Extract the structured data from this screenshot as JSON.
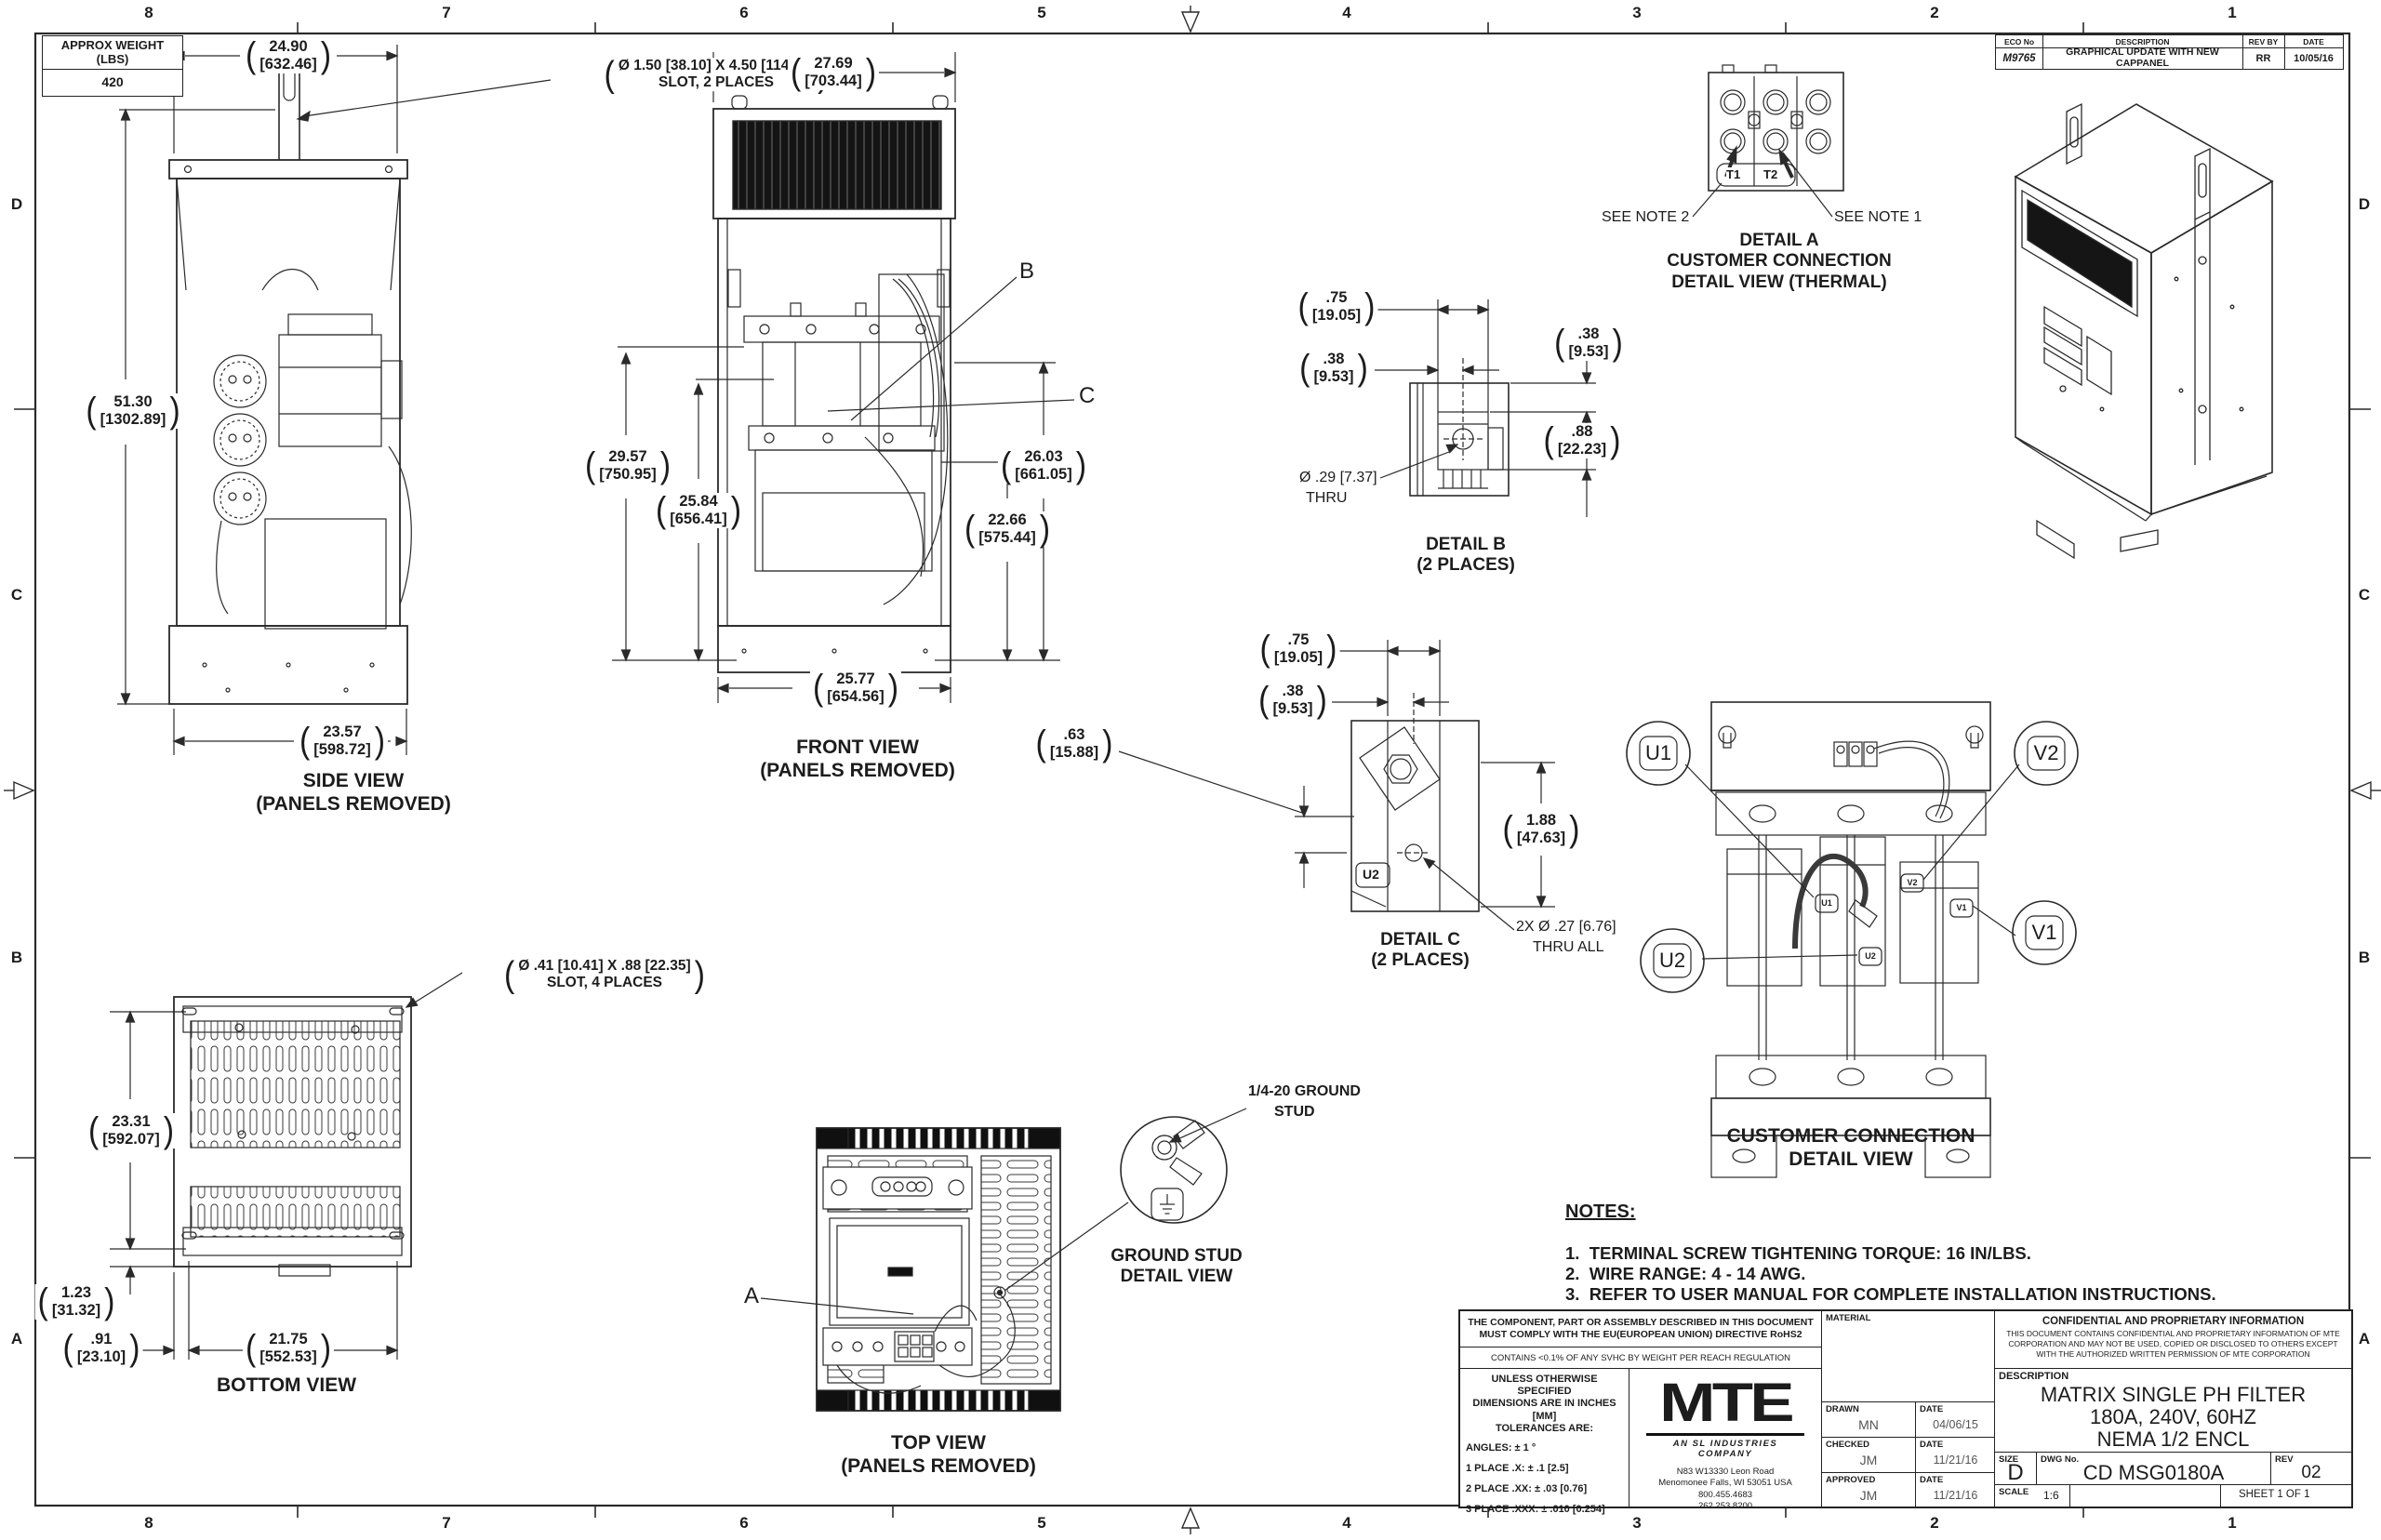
{
  "sheet": {
    "zones_top": [
      "8",
      "7",
      "6",
      "5",
      "4",
      "3",
      "2",
      "1"
    ],
    "zones_bottom": [
      "8",
      "7",
      "6",
      "5",
      "4",
      "3",
      "2",
      "1"
    ],
    "zones_left": [
      "D",
      "C",
      "B",
      "A"
    ],
    "zones_right": [
      "D",
      "C",
      "B",
      "A"
    ]
  },
  "weight_table": {
    "title": "APPROX WEIGHT (LBS)",
    "value": "420"
  },
  "eco": {
    "h_eco": "ECO No",
    "h_desc": "DESCRIPTION",
    "h_rev": "REV BY",
    "h_date": "DATE",
    "eco_no": "M9765",
    "description": "GRAPHICAL UPDATE WITH NEW CAPPANEL",
    "rev_by": "RR",
    "date": "10/05/16"
  },
  "side": {
    "title": "SIDE VIEW",
    "subtitle": "(PANELS REMOVED)",
    "dim_top_in": "24.90",
    "dim_top_mm": "[632.46]",
    "dim_h_in": "51.30",
    "dim_h_mm": "[1302.89]",
    "dim_bot_in": "23.57",
    "dim_bot_mm": "[598.72]",
    "slot1": "Ø 1.50 [38.10]  X 4.50 [114.30]",
    "slot2": "SLOT, 2 PLACES"
  },
  "front": {
    "title": "FRONT VIEW",
    "subtitle": "(PANELS REMOVED)",
    "dim_top_in": "27.69",
    "dim_top_mm": "[703.44]",
    "h1_in": "29.57",
    "h1_mm": "[750.95]",
    "h2_in": "25.84",
    "h2_mm": "[656.41]",
    "h3_in": "26.03",
    "h3_mm": "[661.05]",
    "h4_in": "22.66",
    "h4_mm": "[575.44]",
    "dim_bot_in": "25.77",
    "dim_bot_mm": "[654.56]",
    "label_b": "B",
    "label_c": "C"
  },
  "bottom": {
    "title": "BOTTOM VIEW",
    "dim_h_in": "23.31",
    "dim_h_mm": "[592.07]",
    "dim_o1_in": "1.23",
    "dim_o1_mm": "[31.32]",
    "dim_o2_in": ".91",
    "dim_o2_mm": "[23.10]",
    "dim_w_in": "21.75",
    "dim_w_mm": "[552.53]",
    "slot1": "Ø .41 [10.41]  X .88 [22.35]",
    "slot2": "SLOT, 4 PLACES"
  },
  "top": {
    "title": "TOP VIEW",
    "subtitle": "(PANELS REMOVED)",
    "label_a": "A"
  },
  "ground": {
    "callout1": "1/4-20 GROUND",
    "callout2": "STUD",
    "title1": "GROUND STUD",
    "title2": "DETAIL VIEW"
  },
  "detail_a": {
    "t1": "T1",
    "t2": "T2",
    "note2": "SEE NOTE 2",
    "note1": "SEE NOTE 1",
    "title1": "DETAIL A",
    "title2": "CUSTOMER CONNECTION",
    "title3": "DETAIL VIEW (THERMAL)"
  },
  "detail_b": {
    "d1_in": ".75",
    "d1_mm": "[19.05]",
    "d2_in": ".38",
    "d2_mm": "[9.53]",
    "d3_in": ".38",
    "d3_mm": "[9.53]",
    "d4_in": ".88",
    "d4_mm": "[22.23]",
    "hole1": "Ø .29 [7.37]",
    "hole2": "THRU",
    "title1": "DETAIL B",
    "title2": "(2 PLACES)"
  },
  "detail_c": {
    "d1_in": ".75",
    "d1_mm": "[19.05]",
    "d2_in": ".38",
    "d2_mm": "[9.53]",
    "d3_in": ".63",
    "d3_mm": "[15.88]",
    "d4_in": "1.88",
    "d4_mm": "[47.63]",
    "hole1": "2X Ø .27 [6.76]",
    "hole2": "THRU ALL",
    "u2": "U2",
    "title1": "DETAIL C",
    "title2": "(2 PLACES)"
  },
  "connection": {
    "title1": "CUSTOMER CONNECTION",
    "title2": "DETAIL VIEW",
    "u1": "U1",
    "v2": "V2",
    "u2": "U2",
    "v1": "V1",
    "tag_u1": "U1",
    "tag_v2": "V2",
    "tag_u2": "U2",
    "tag_v1": "V1"
  },
  "notes": {
    "title": "NOTES:",
    "item1": "1.  TERMINAL SCREW TIGHTENING TORQUE: 16 IN/LBS.",
    "item2": "2.  WIRE RANGE: 4 - 14 AWG.",
    "item3": "3.  REFER TO USER MANUAL FOR COMPLETE INSTALLATION INSTRUCTIONS."
  },
  "tb": {
    "compliance1": "THE COMPONENT, PART OR ASSEMBLY DESCRIBED IN THIS DOCUMENT",
    "compliance1b": "MUST COMPLY WITH THE EU(EUROPEAN UNION) DIRECTIVE RoHS2",
    "compliance2": "CONTAINS <0.1% OF ANY SVHC BY WEIGHT PER REACH REGULATION",
    "tol_head1": "UNLESS OTHERWISE SPECIFIED",
    "tol_head2": "DIMENSIONS ARE IN INCHES [MM]",
    "tol_head3": "TOLERANCES ARE:",
    "tol1": "ANGLES: ± 1 °",
    "tol2": "1 PLACE .X: ± .1 [2.5]",
    "tol3": "2 PLACE .XX: ± .03 [0.76]",
    "tol4": "3 PLACE .XXX: ± .010 [0.254]",
    "logo": "MTE",
    "logo_tag": "AN SL INDUSTRIES COMPANY",
    "addr1": "N83 W13330 Leon Road",
    "addr2": "Menomonee Falls, WI 53051 USA",
    "addr3": "800.455.4683",
    "addr4": "262.253.8200",
    "material": "MATERIAL",
    "drawn_label": "DRAWN",
    "drawn": "MN",
    "drawn_date_label": "DATE",
    "drawn_date": "04/06/15",
    "checked_label": "CHECKED",
    "checked": "JM",
    "checked_date_label": "DATE",
    "checked_date": "11/21/16",
    "approved_label": "APPROVED",
    "approved": "JM",
    "approved_date_label": "DATE",
    "approved_date": "11/21/16",
    "conf_title": "CONFIDENTIAL AND PROPRIETARY INFORMATION",
    "conf1": "THIS DOCUMENT CONTAINS CONFIDENTIAL AND PROPRIETARY INFORMATION OF MTE",
    "conf2": "CORPORATION AND MAY NOT BE USED, COPIED OR DISCLOSED TO OTHERS EXCEPT",
    "conf3": "WITH THE AUTHORIZED WRITTEN PERMISSION OF MTE CORPORATION",
    "desc_label": "DESCRIPTION",
    "desc1": "MATRIX SINGLE PH FILTER",
    "desc2": "180A, 240V, 60HZ",
    "desc3": "NEMA 1/2 ENCL",
    "size_label": "SIZE",
    "size": "D",
    "dwg_label": "DWG No.",
    "dwg": "CD MSG0180A",
    "rev_label": "REV",
    "rev": "02",
    "scale_label": "SCALE",
    "scale": "1:6",
    "sheet": "SHEET 1  OF 1"
  }
}
